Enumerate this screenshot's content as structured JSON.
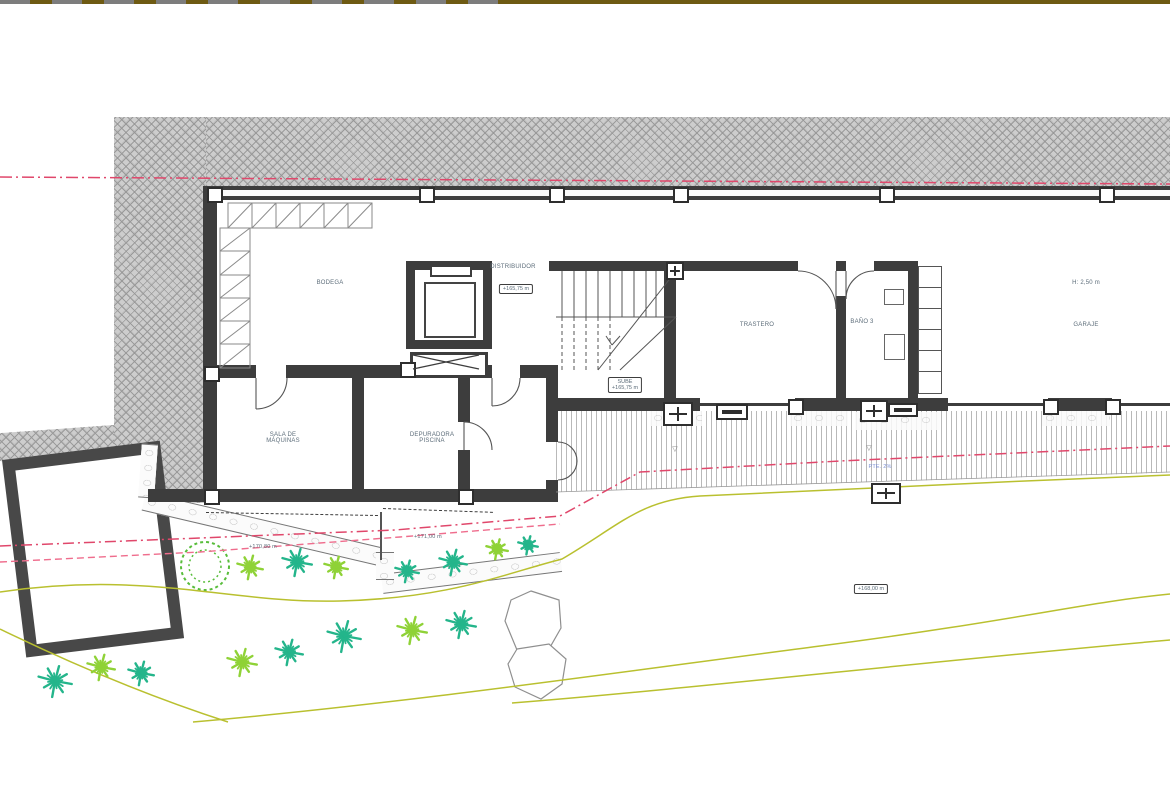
{
  "plan": {
    "rooms": {
      "bodega": "BODEGA",
      "distribuidor": "DISTRIBUIDOR",
      "trastero": "TRASTERO",
      "bano": "BAÑO 3",
      "garaje": "GARAJE",
      "garaje_height": "H: 2,50 m",
      "sala_line1": "SALA DE",
      "sala_line2": "MÁQUINAS",
      "depuradora_line1": "DEPURADORA",
      "depuradora_line2": "PISCINA"
    },
    "levels": {
      "distribuidor_level": "+165,75 m",
      "stairs_line1": "SUBE",
      "stairs_line2": "+165,75 m",
      "planter1_level": "+170,80 m",
      "planter2_level": "+171,00 m",
      "terrain_level": "+168,00 m",
      "slope_note": "PTE. 2%"
    },
    "colors": {
      "wall": "#3d3d3d",
      "terrain_hatch": "#cdcdcd",
      "boundary_red": "#e0476b",
      "contour_olive": "#b9c02f",
      "palm_teal": "#24b58b",
      "palm_lime": "#8fd237",
      "tree_green": "#58bd3b",
      "topbar_olive": "#6e5a12"
    }
  },
  "landscape": {
    "palms": [
      {
        "x": 250,
        "y": 567,
        "r": 13,
        "c": "lime"
      },
      {
        "x": 297,
        "y": 562,
        "r": 15,
        "c": "teal"
      },
      {
        "x": 336,
        "y": 567,
        "r": 12,
        "c": "lime"
      },
      {
        "x": 407,
        "y": 571,
        "r": 12,
        "c": "teal"
      },
      {
        "x": 453,
        "y": 562,
        "r": 14,
        "c": "teal"
      },
      {
        "x": 497,
        "y": 549,
        "r": 11,
        "c": "lime"
      },
      {
        "x": 528,
        "y": 545,
        "r": 10,
        "c": "teal"
      },
      {
        "x": 344,
        "y": 636,
        "r": 17,
        "c": "teal"
      },
      {
        "x": 412,
        "y": 630,
        "r": 15,
        "c": "lime"
      },
      {
        "x": 461,
        "y": 624,
        "r": 15,
        "c": "teal"
      },
      {
        "x": 55,
        "y": 681,
        "r": 17,
        "c": "teal"
      },
      {
        "x": 101,
        "y": 667,
        "r": 14,
        "c": "lime"
      },
      {
        "x": 141,
        "y": 673,
        "r": 13,
        "c": "teal"
      },
      {
        "x": 242,
        "y": 662,
        "r": 15,
        "c": "lime"
      },
      {
        "x": 289,
        "y": 652,
        "r": 14,
        "c": "teal"
      }
    ]
  }
}
